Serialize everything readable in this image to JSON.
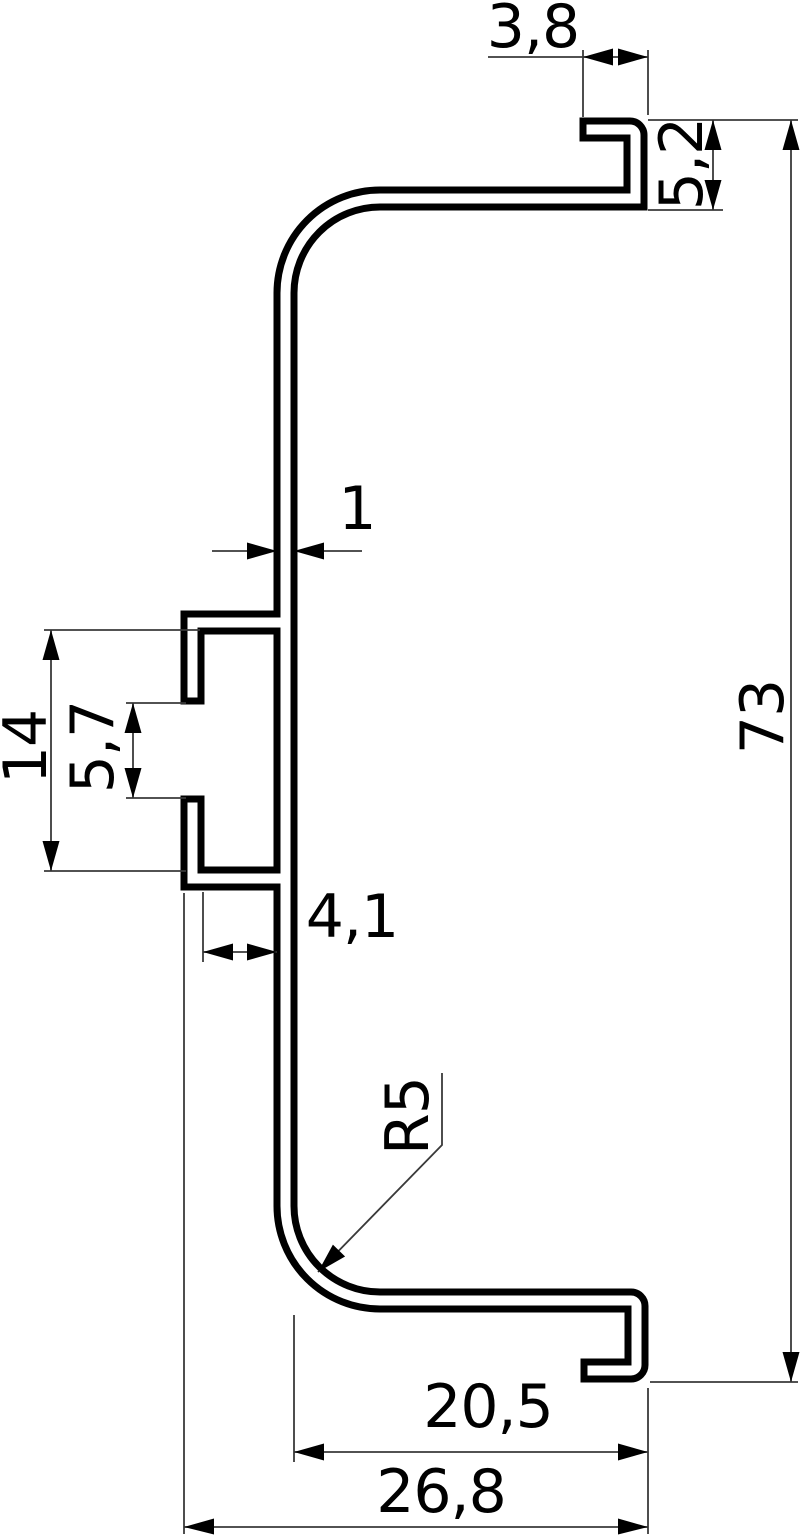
{
  "drawing": {
    "background_color": "#ffffff",
    "profile_color": "#000000",
    "dimension_color": "#3a3a3a",
    "dimensions": {
      "top_hook_width": {
        "label": "3,8",
        "orientation": "horizontal"
      },
      "top_hook_height": {
        "label": "5,2",
        "orientation": "vertical-rotated"
      },
      "wall_thickness": {
        "label": "1",
        "orientation": "horizontal"
      },
      "clip_height": {
        "label": "14",
        "orientation": "vertical-rotated"
      },
      "clip_gap": {
        "label": "5,7",
        "orientation": "vertical-rotated"
      },
      "clip_depth": {
        "label": "4,1",
        "orientation": "horizontal"
      },
      "overall_height": {
        "label": "73",
        "orientation": "vertical-rotated"
      },
      "bottom_radius": {
        "label": "R5",
        "orientation": "leader-rotated"
      },
      "bottom_inner_width": {
        "label": "20,5",
        "orientation": "horizontal"
      },
      "bottom_outer_width": {
        "label": "26,8",
        "orientation": "horizontal"
      }
    }
  }
}
